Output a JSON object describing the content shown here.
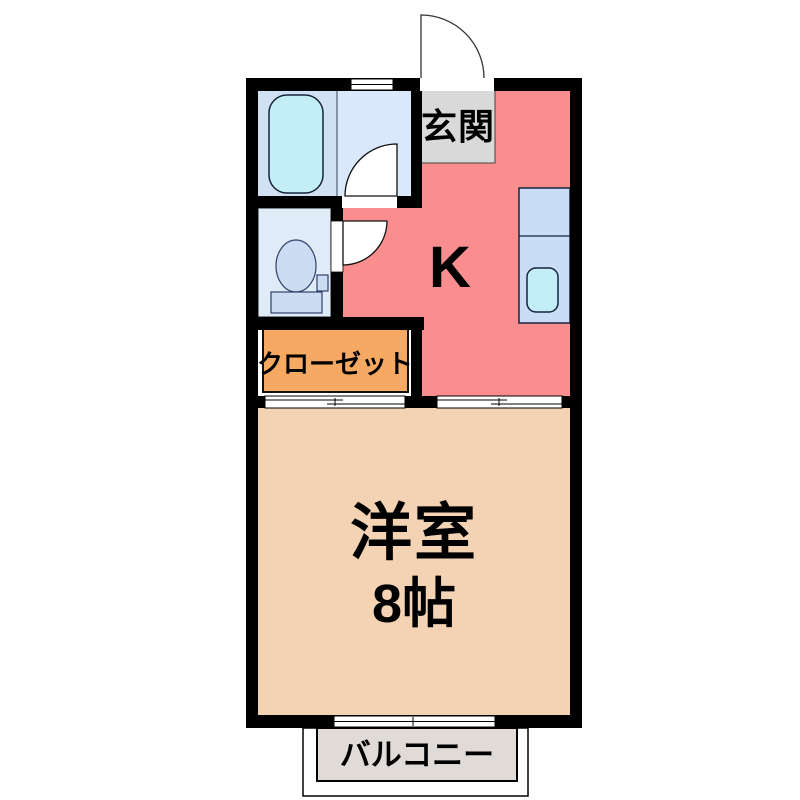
{
  "floor_plan": {
    "labels": {
      "genkan": "玄関",
      "kitchen": "K",
      "closet": "クローゼット",
      "main_room_name": "洋室",
      "main_room_size": "8帖",
      "balcony": "バルコニー"
    },
    "colors": {
      "wall": "#000000",
      "kitchen_floor": "#fa8e8e",
      "genkan_floor": "#d9d9d9",
      "closet_floor": "#f5a963",
      "main_room_floor": "#f3d3b3",
      "balcony_floor": "#e0dbd6",
      "bathroom_floor": "#cfe1f3",
      "bathroom_floor_light": "#d9e8fa",
      "toilet_floor": "#e0ebf8",
      "counter": "#c9ddf6",
      "tub_sink": "#c3eef8",
      "toilet_fixture": "#cbdcf3"
    }
  }
}
